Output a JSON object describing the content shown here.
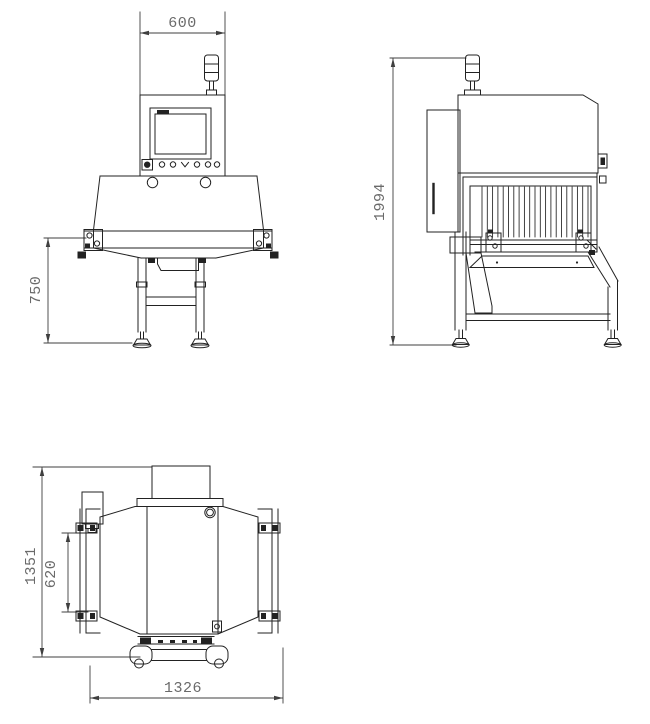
{
  "colors": {
    "line": "#222222",
    "dimension_line": "#3f3f3f",
    "dimension_text": "#6a6a6a",
    "background": "#ffffff"
  },
  "front_view": {
    "dim_head_width": "600",
    "dim_belt_height": "750"
  },
  "side_view": {
    "dim_overall_height": "1994"
  },
  "plan_view": {
    "dim_overall_depth": "1351",
    "dim_belt_width": "620",
    "dim_overall_length": "1326"
  }
}
